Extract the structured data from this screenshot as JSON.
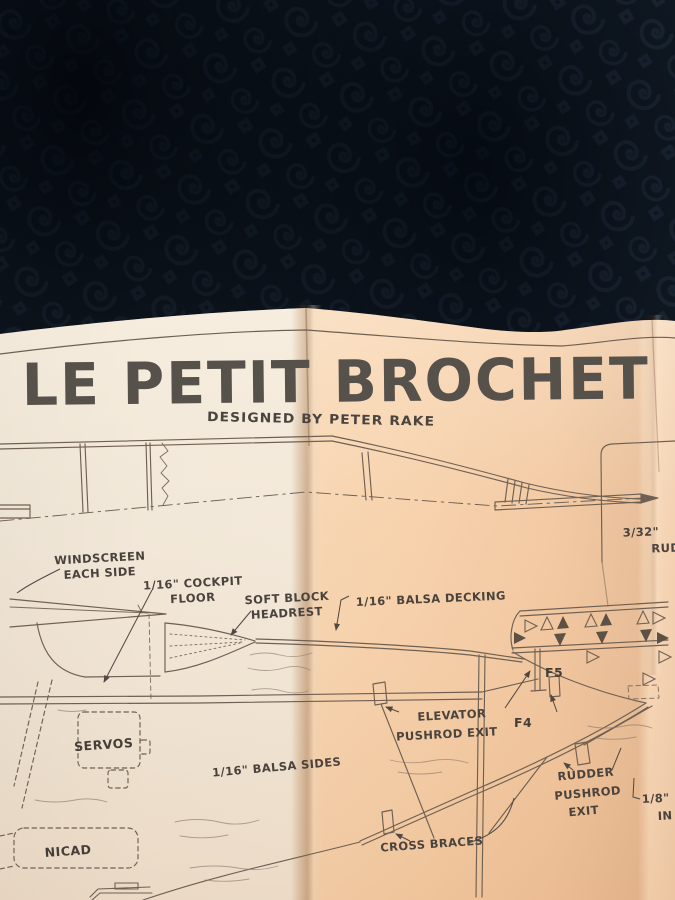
{
  "plan": {
    "title": "LE PETIT BROCHET",
    "subtitle": "DESIGNED BY PETER RAKE",
    "labels": {
      "windscreen_1": "WINDSCREEN",
      "windscreen_2": "EACH SIDE",
      "cockpit_floor_1": "1/16\" COCKPIT",
      "cockpit_floor_2": "FLOOR",
      "headrest_1": "SOFT BLOCK",
      "headrest_2": "HEADREST",
      "decking": "1/16\" BALSA DECKING",
      "rudder_note_1": "3/32\"",
      "rudder_note_2": "RUD",
      "former_f5": "F5",
      "elevator_exit_1": "ELEVATOR",
      "elevator_exit_2": "PUSHROD EXIT",
      "former_f4": "F4",
      "servos": "SERVOS",
      "balsa_sides": "1/16\" BALSA SIDES",
      "rudder_exit_1": "RUDDER",
      "rudder_exit_2": "PUSHROD",
      "rudder_exit_3": "EXIT",
      "stock_note_1": "1/8\"",
      "stock_note_2": "IN",
      "cross_braces": "CROSS BRACES",
      "nicad": "NICAD"
    },
    "colors": {
      "fabric": "#131d28",
      "fabric_swirl": "#2a3b4d",
      "paper_left": "#f0e6d7",
      "paper_right": "#f5cda6",
      "ink": "#6f6053",
      "label_text": "#4a433d",
      "title_text": "#57514c"
    }
  }
}
